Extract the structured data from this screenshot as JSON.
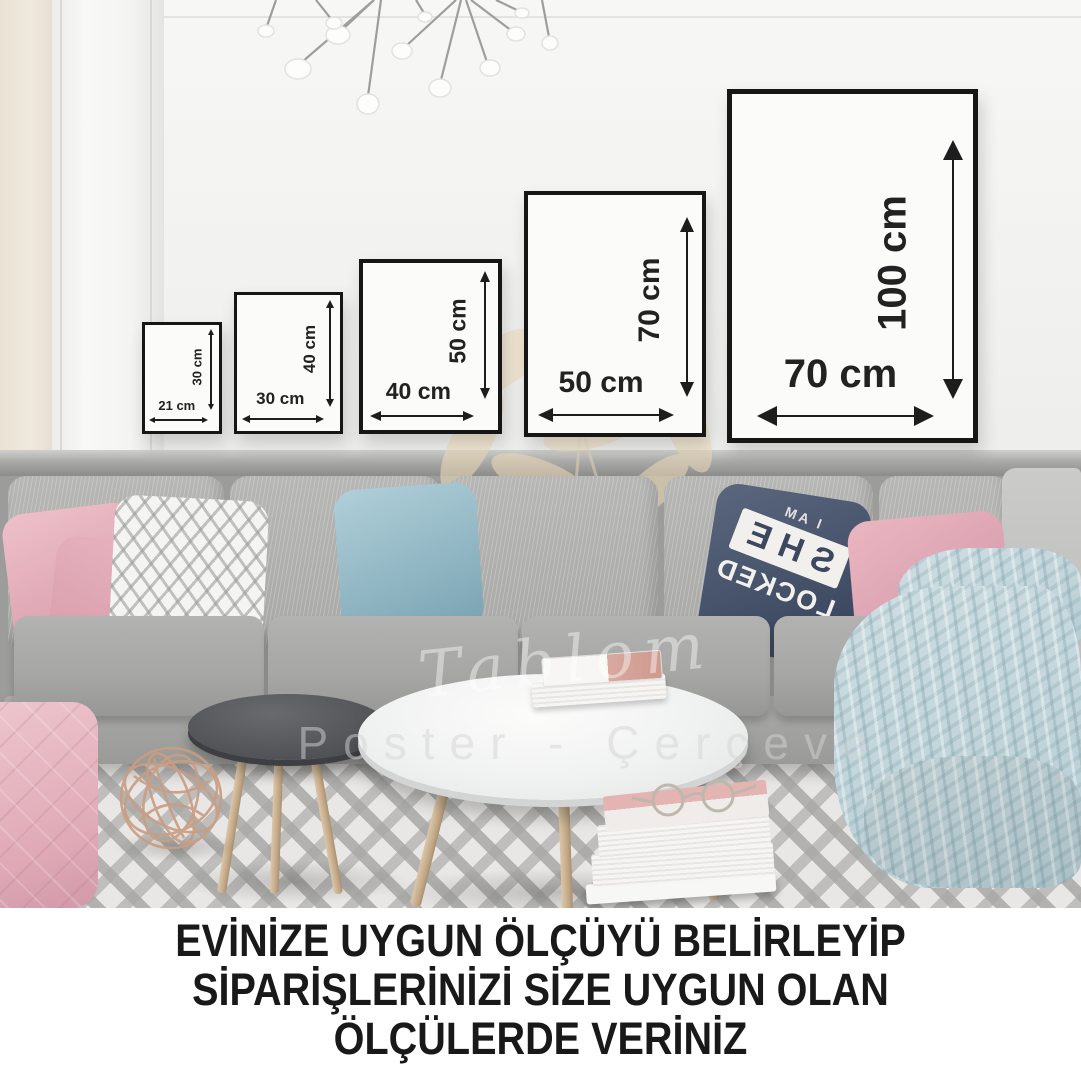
{
  "frames": [
    {
      "name": "frame-21x30",
      "width_label": "21 cm",
      "height_label": "30 cm"
    },
    {
      "name": "frame-30x40",
      "width_label": "30 cm",
      "height_label": "40 cm"
    },
    {
      "name": "frame-40x50",
      "width_label": "40 cm",
      "height_label": "50 cm"
    },
    {
      "name": "frame-50x70",
      "width_label": "50 cm",
      "height_label": "70 cm"
    },
    {
      "name": "frame-70x100",
      "width_label": "70 cm",
      "height_label": "100 cm"
    }
  ],
  "pillow": {
    "line1": "I AM",
    "line2": "SHE",
    "line3": "LOCKED",
    "note": "text appears mirrored on the cushion"
  },
  "watermark": {
    "script": "Tablom",
    "subtitle": "Poster - Çerçeve"
  },
  "caption": {
    "line1": "EVİNİZE UYGUN ÖLÇÜYÜ BELİRLEYİP",
    "line2": "SİPARİŞLERİNİZİ SİZE UYGUN OLAN",
    "line3": "ÖLÇÜLERDE VERİNİZ"
  },
  "colors": {
    "frame_border": "#161616",
    "frame_fill": "#fbfbf9",
    "dimension_text": "#1d1d1d",
    "wall_upper": "#f3f3f1",
    "wainscot_gray": "#9c9c9a",
    "sofa_gray": "#aeaeac",
    "pillow_pink": "#dfa9b6",
    "pillow_teal": "#8fb5c2",
    "pillow_navy": "#46526a",
    "blanket_blue": "#bfd4da",
    "flower_watermark": "#eedcba",
    "caption_text": "#191919"
  }
}
